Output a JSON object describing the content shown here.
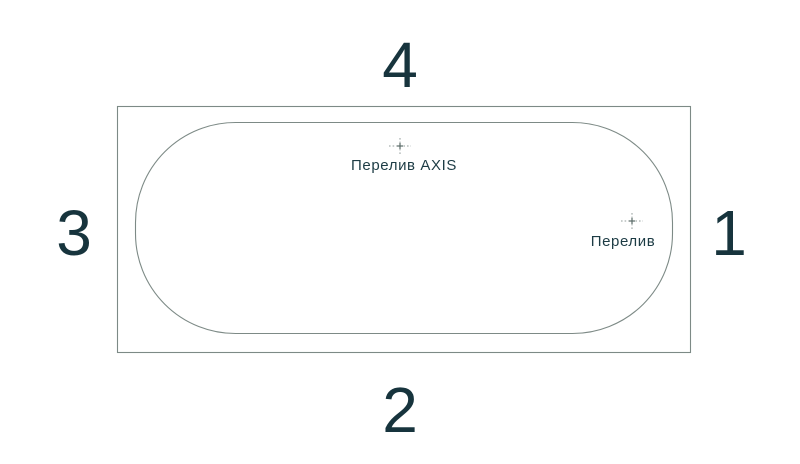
{
  "diagram": {
    "sides": [
      {
        "position": "right",
        "number": "1"
      },
      {
        "position": "bottom",
        "number": "2"
      },
      {
        "position": "left",
        "number": "3"
      },
      {
        "position": "top",
        "number": "4"
      }
    ],
    "markers": [
      {
        "id": "overflow-axis",
        "label": "Перелив AXIS"
      },
      {
        "id": "overflow",
        "label": "Перелив"
      }
    ],
    "colors": {
      "outline": "#7d8a86",
      "number_text": "#17343d",
      "label_text": "#1d3c45",
      "center_mark": "#939d9b",
      "center_mark_core": "#5a6a68",
      "background": "#ffffff"
    }
  }
}
